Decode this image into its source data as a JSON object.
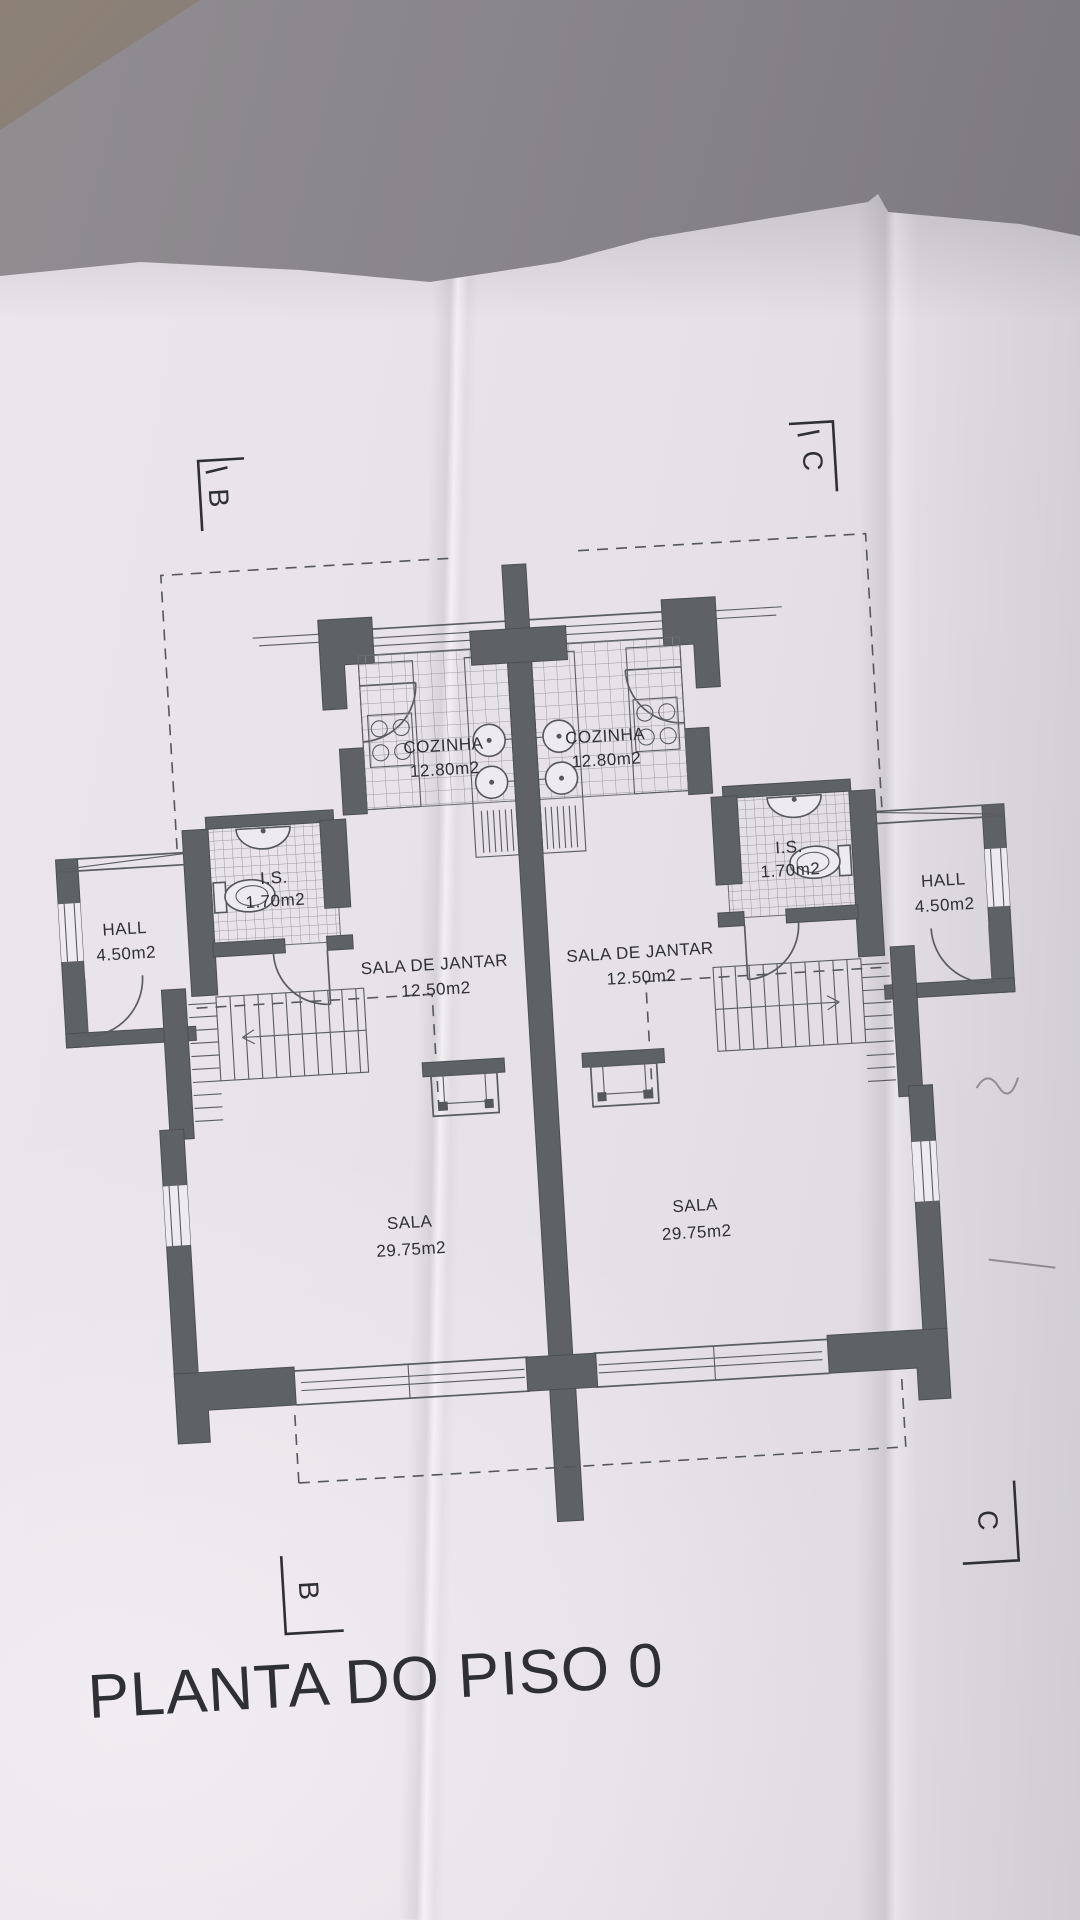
{
  "title": "PLANTA DO PISO 0",
  "plan": {
    "units": [
      {
        "side": "left",
        "rooms": [
          {
            "name": "COZINHA",
            "area": "12.80m2"
          },
          {
            "name": "I.S.",
            "area": "1.70m2"
          },
          {
            "name": "HALL",
            "area": "4.50m2"
          },
          {
            "name": "SALA DE JANTAR",
            "area": "12.50m2"
          },
          {
            "name": "SALA",
            "area": "29.75m2"
          }
        ]
      },
      {
        "side": "right",
        "rooms": [
          {
            "name": "COZINHA",
            "area": "12.80m2"
          },
          {
            "name": "I.S.",
            "area": "1.70m2"
          },
          {
            "name": "HALL",
            "area": "4.50m2"
          },
          {
            "name": "SALA DE JANTAR",
            "area": "12.50m2"
          },
          {
            "name": "SALA",
            "area": "29.75m2"
          }
        ]
      }
    ],
    "section_markers": [
      {
        "position": "top-left",
        "letter": "B",
        "prime": true
      },
      {
        "position": "top-right",
        "letter": "C",
        "prime": true
      },
      {
        "position": "bottom-left",
        "letter": "B",
        "prime": false
      },
      {
        "position": "bottom-right",
        "letter": "C",
        "prime": false
      }
    ]
  },
  "colors": {
    "paper": "#e8e4e9",
    "background": "#84818a",
    "wall": "#5e6166",
    "ink": "#2e3034",
    "table_corner": "#8b8074"
  }
}
